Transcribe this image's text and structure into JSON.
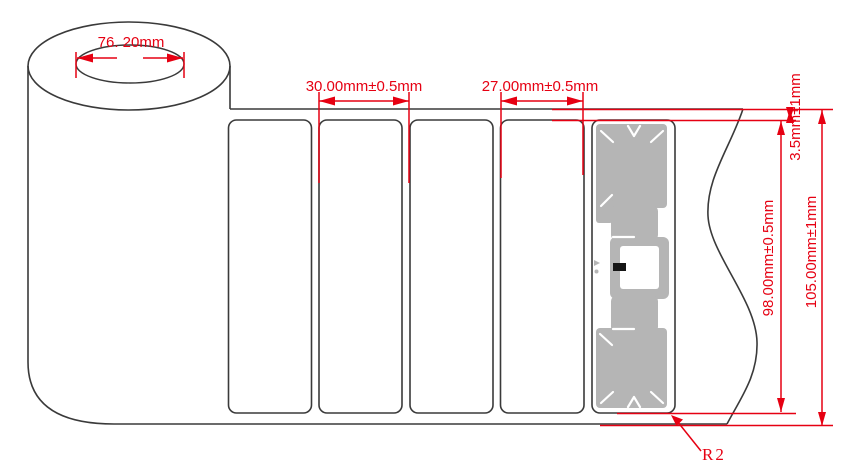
{
  "drawing": {
    "title": "RFID label roll dimension drawing",
    "colors": {
      "dimension_red": "#e60012",
      "outline_black": "#3a3a3a",
      "inlay_gray": "#b5b5b5",
      "chip_black": "#151515",
      "background": "#ffffff"
    },
    "dims": {
      "core_diameter": "76. 20mm",
      "label_pitch": "30.00mm±0.5mm",
      "label_width": "27.00mm±0.5mm",
      "top_margin": "3.5mm±1mm",
      "label_height": "98.00mm±0.5mm",
      "liner_width": "105.00mm±1mm",
      "corner_radius": "R2"
    },
    "labels": {
      "count": 5,
      "rfid_inlay_on_label": 5
    }
  }
}
